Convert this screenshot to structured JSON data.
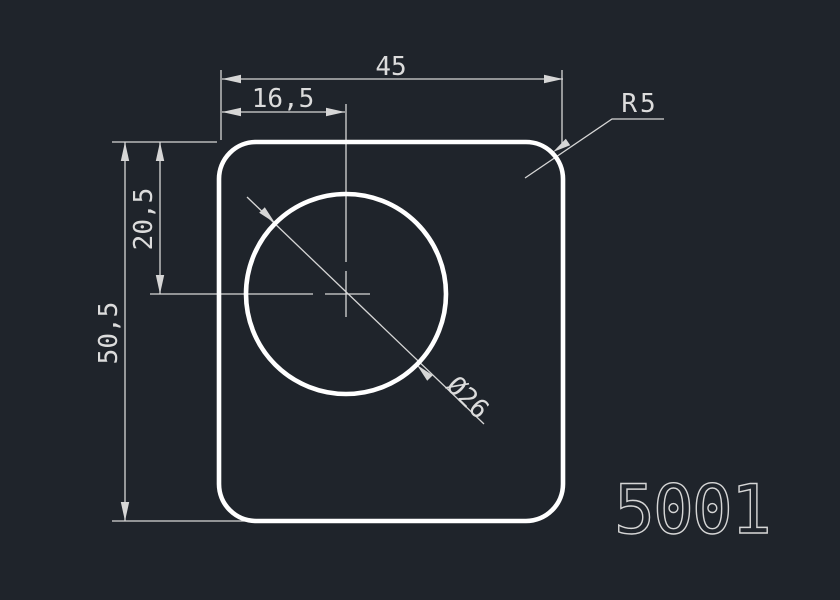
{
  "canvas": {
    "background_color": "#1f242b",
    "outline_color": "#ffffff",
    "dimension_color": "#d6d6d6",
    "style": "CAD technical drawing, dark model-space background"
  },
  "drawing": {
    "part_number": "5001",
    "shape_description": "rounded square profile with circular hole",
    "dimensions": {
      "overall_width": "45",
      "hole_center_from_left": "16,5",
      "hole_center_from_top": "20,5",
      "overall_height": "50,5",
      "hole_diameter": "Ø26",
      "corner_radius": "R5"
    }
  }
}
